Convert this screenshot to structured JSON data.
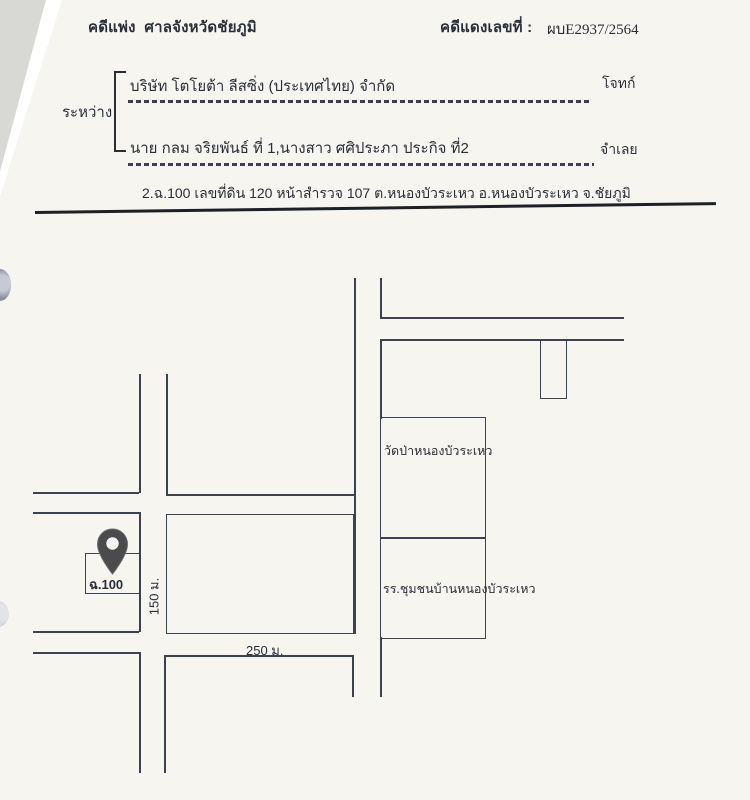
{
  "header": {
    "case_type": "คดีแพ่ง",
    "court": "ศาลจังหวัดชัยภูมิ",
    "red_case_label": "คดีแดงเลขที่ :",
    "red_case_number": "ผบE2937/2564"
  },
  "parties": {
    "between_label": "ระหว่าง",
    "plaintiff_name": "บริษัท โตโยต้า ลีสซิ่ง (ประเทศไทย) จำกัด",
    "plaintiff_role": "โจทก์",
    "defendant_name": "นาย กลม จริยพันธ์ ที่ 1,นางสาว ศศิประภา ประกิจ ที่2",
    "defendant_role": "จำเลย"
  },
  "land_description": "2.ฉ.100 เลขที่ดิน 120 หน้าสำรวจ 107 ต.หนองบัวระเหว อ.หนองบัวระเหว จ.ชัยภูมิ",
  "map": {
    "temple_label": "วัดป่าหนองบัวระเหว",
    "school_label": "รร.ชุมชนบ้านหนองบัวระเหว",
    "plot_label": "ฉ.100",
    "vertical_distance": "150 ม.",
    "horizontal_distance": "250 ม.",
    "pin_icon": "location-pin-icon"
  },
  "colors": {
    "ink": "#2a2e39",
    "ink_soft": "#3b404c",
    "map_line": "#3c4250",
    "paper": "#f6f5f0",
    "scanner_bg": "#d8d8d4",
    "pin": "#4b4b4e"
  }
}
